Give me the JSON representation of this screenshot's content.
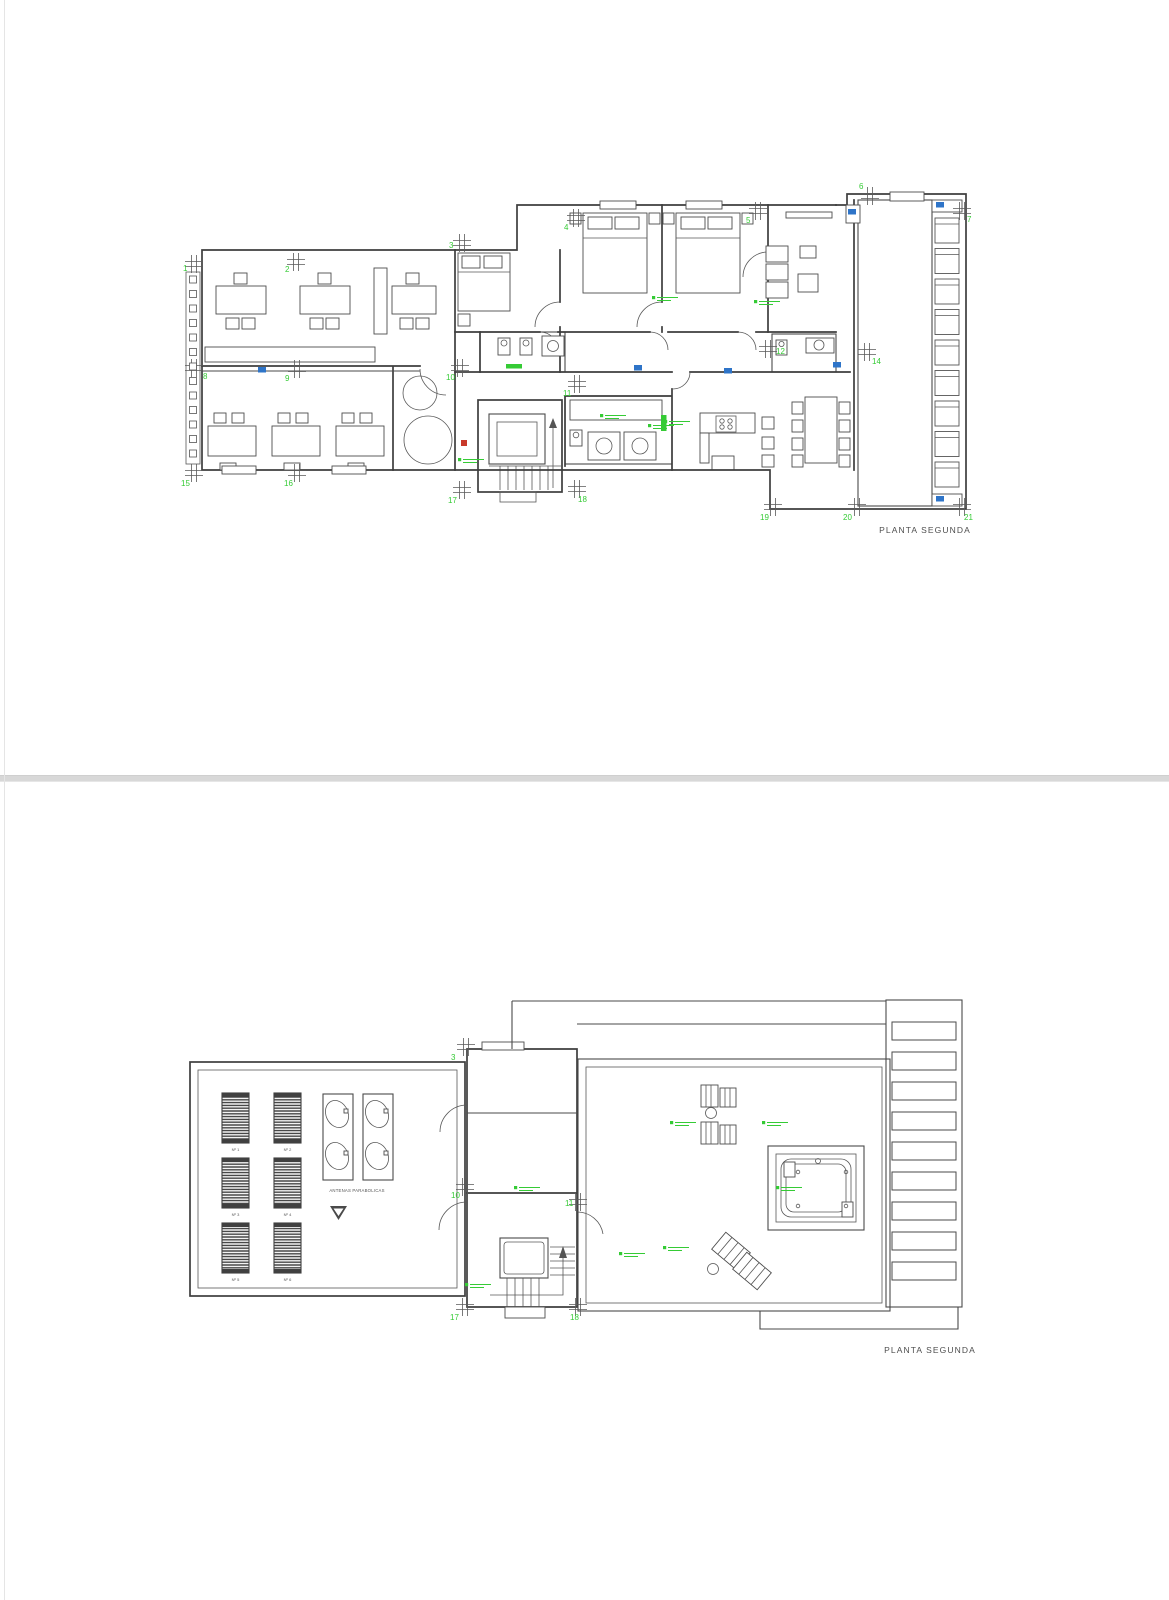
{
  "document_type": "architectural-floor-plans",
  "colors": {
    "green": "#35cb35",
    "blue": "#2e74c8",
    "red": "#c8392b",
    "line": "#3e3e3e"
  },
  "pages": [
    {
      "title": "PLANTA SEGUNDA",
      "grid_markers": [
        {
          "n": "1",
          "x": 194,
          "y": 264,
          "lx": 183,
          "ly": 271
        },
        {
          "n": "2",
          "x": 296,
          "y": 262,
          "lx": 285,
          "ly": 272
        },
        {
          "n": "3",
          "x": 462,
          "y": 243,
          "lx": 449,
          "ly": 248
        },
        {
          "n": "4",
          "x": 576,
          "y": 218,
          "lx": 564,
          "ly": 230
        },
        {
          "n": "5",
          "x": 758,
          "y": 211,
          "lx": 746,
          "ly": 223
        },
        {
          "n": "6",
          "x": 870,
          "y": 196,
          "lx": 859,
          "ly": 189
        },
        {
          "n": "7",
          "x": 962,
          "y": 211,
          "lx": 967,
          "ly": 222
        },
        {
          "n": "8",
          "x": 194,
          "y": 368,
          "lx": 203,
          "ly": 379
        },
        {
          "n": "9",
          "x": 297,
          "y": 369,
          "lx": 285,
          "ly": 381
        },
        {
          "n": "10",
          "x": 460,
          "y": 368,
          "lx": 446,
          "ly": 380
        },
        {
          "n": "11",
          "x": 577,
          "y": 384,
          "lx": 563,
          "ly": 396
        },
        {
          "n": "12",
          "x": 768,
          "y": 349,
          "lx": 776,
          "ly": 354
        },
        {
          "n": "14",
          "x": 867,
          "y": 352,
          "lx": 872,
          "ly": 364
        },
        {
          "n": "15",
          "x": 194,
          "y": 473,
          "lx": 181,
          "ly": 486
        },
        {
          "n": "16",
          "x": 297,
          "y": 473,
          "lx": 284,
          "ly": 486
        },
        {
          "n": "17",
          "x": 462,
          "y": 490,
          "lx": 448,
          "ly": 503
        },
        {
          "n": "18",
          "x": 577,
          "y": 489,
          "lx": 578,
          "ly": 502
        },
        {
          "n": "19",
          "x": 773,
          "y": 507,
          "lx": 760,
          "ly": 520
        },
        {
          "n": "20",
          "x": 857,
          "y": 507,
          "lx": 843,
          "ly": 520
        },
        {
          "n": "21",
          "x": 962,
          "y": 507,
          "lx": 964,
          "ly": 520
        }
      ],
      "green_dashes": [
        [
          652,
          296
        ],
        [
          754,
          300
        ],
        [
          600,
          414
        ],
        [
          648,
          424
        ],
        [
          664,
          420
        ],
        [
          458,
          458
        ]
      ],
      "blue_marks": [
        [
          258,
          367
        ],
        [
          634,
          365
        ],
        [
          724,
          368
        ],
        [
          833,
          362
        ],
        [
          848,
          209
        ],
        [
          936,
          202
        ],
        [
          936,
          496
        ]
      ],
      "red_marks": [
        [
          461,
          440
        ]
      ],
      "wall_ticks": {
        "x": 189.5,
        "y0": 276,
        "step": 14.5,
        "n": 13,
        "s": 7
      },
      "loungers": {
        "x": 935,
        "y0": 218,
        "step": 30.5,
        "n": 9,
        "w": 24,
        "h": 25
      }
    },
    {
      "title": "PLANTA SEGUNDA",
      "antenna_label": "ANTENAS PARABOLICAS",
      "grid_markers": [
        {
          "n": "3",
          "x": 466,
          "y": 265,
          "lx": 451,
          "ly": 278
        },
        {
          "n": "10",
          "x": 465,
          "y": 405,
          "lx": 451,
          "ly": 416
        },
        {
          "n": "11",
          "x": 578,
          "y": 420,
          "lx": 565,
          "ly": 424
        },
        {
          "n": "17",
          "x": 465,
          "y": 525,
          "lx": 450,
          "ly": 538
        },
        {
          "n": "18",
          "x": 578,
          "y": 525,
          "lx": 570,
          "ly": 538
        }
      ],
      "green_dashes": [
        [
          670,
          339
        ],
        [
          762,
          339
        ],
        [
          776,
          404
        ],
        [
          663,
          464
        ],
        [
          619,
          470
        ],
        [
          514,
          404
        ],
        [
          465,
          501
        ]
      ],
      "solar_panels": {
        "cols": [
          222,
          274
        ],
        "rows": [
          311,
          376,
          441
        ],
        "w": 27,
        "h": 50,
        "labels": [
          "Nº 1",
          "Nº 2",
          "Nº 3",
          "Nº 4",
          "Nº 5",
          "Nº 6"
        ]
      },
      "pergola_slats": {
        "x": 892,
        "y0": 240,
        "step": 30,
        "n": 9,
        "w": 64,
        "h": 18
      }
    }
  ]
}
